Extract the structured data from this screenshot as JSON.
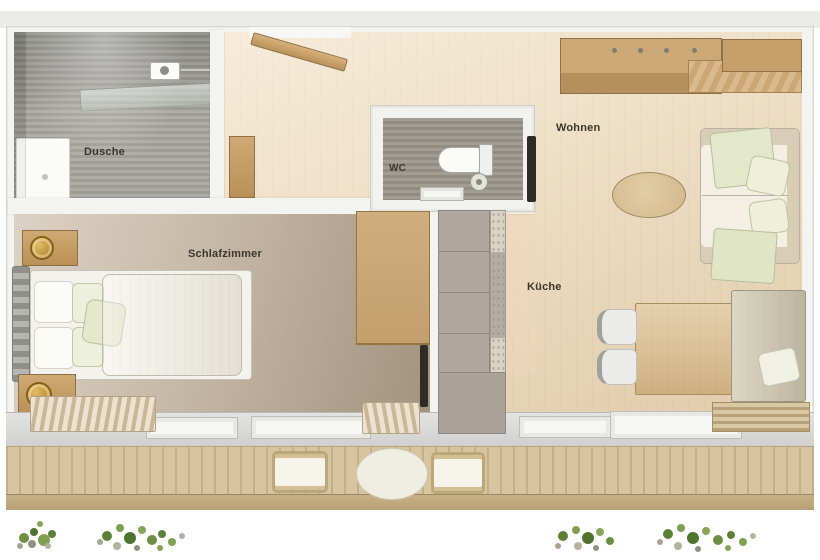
{
  "plan": {
    "type": "apartment-floor-plan",
    "rooms": {
      "bathroom": {
        "label": "Dusche"
      },
      "wc": {
        "label": "WC"
      },
      "living": {
        "label": "Wohnen"
      },
      "bedroom": {
        "label": "Schlafzimmer"
      },
      "kitchen": {
        "label": "Küche"
      }
    }
  },
  "colors": {
    "label_text": "#3c372d",
    "wood_floor": "#eddbbf",
    "bedroom_floor": "#c6b8a6",
    "tile_gray": "#a5a39b",
    "furniture_wood": "#c8a370",
    "cushion_green": "#e3e8cb",
    "sofa_cream": "#f3efe2",
    "counter_taupe": "#b1a7a1",
    "deck_wood": "#d8c5a0",
    "plant_green": "#5d8039",
    "lamp_gold": "#c0953d",
    "door_dark": "#2f2b26"
  }
}
